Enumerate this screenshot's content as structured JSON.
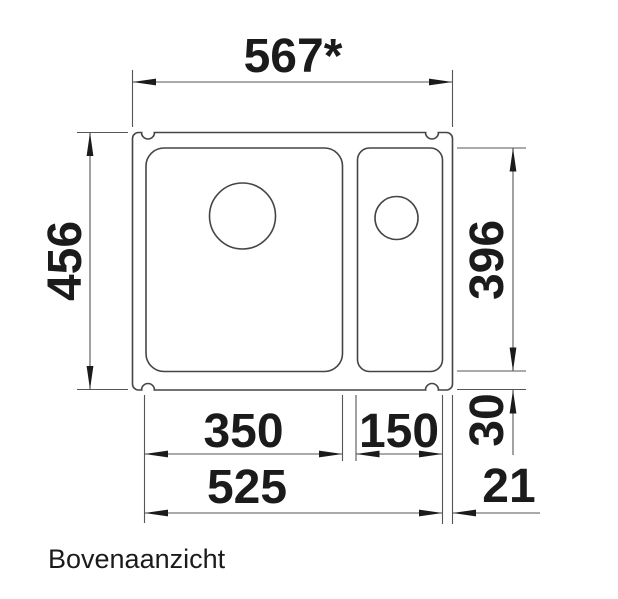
{
  "colors": {
    "background": "#ffffff",
    "outline": "#454545",
    "dimension-line": "#555555",
    "text": "#1b1b1b"
  },
  "drawing": {
    "caption": "Bovenaanzicht",
    "dimensions": {
      "overall_width": "567*",
      "overall_depth": "456",
      "basin_depth": "396",
      "main_basin_width": "350",
      "side_basin_width": "150",
      "rear_ledge_depth": "30",
      "basins_total_width": "525",
      "right_edge_width": "21"
    }
  }
}
